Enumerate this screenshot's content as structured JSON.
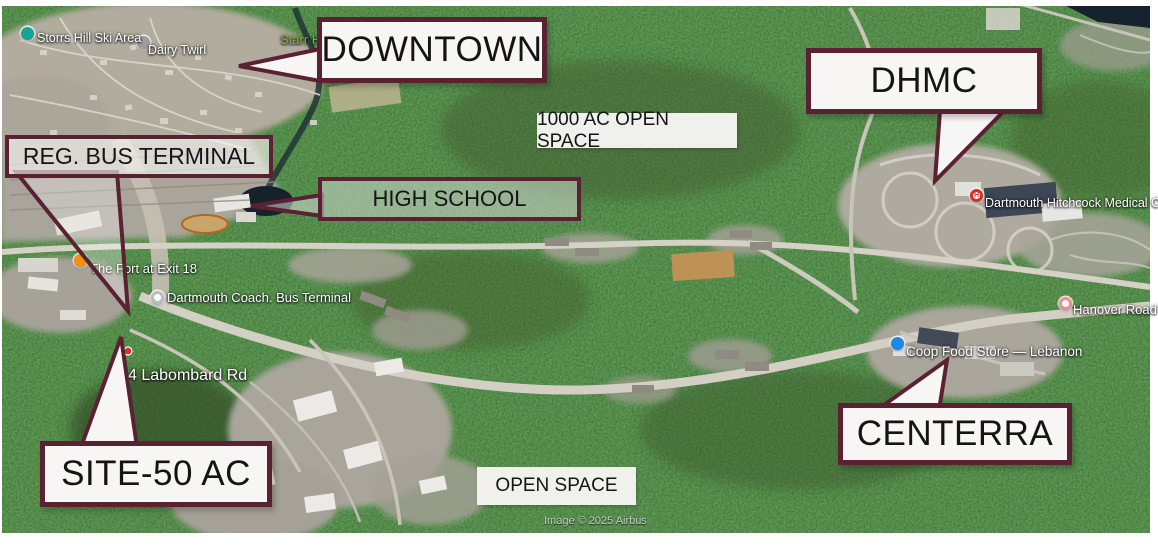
{
  "colors": {
    "callout_border": "#5a2133",
    "callout_fill": "#f8f6f4",
    "forest_base": "#273c1d",
    "park_label_green": "#8aa83e",
    "hospital_pin_red": "#d93025",
    "store_pin_blue": "#1e88e5",
    "restaurant_pin_orange": "#f29111",
    "park_pin_teal": "#18a493"
  },
  "callouts": [
    {
      "name": "downtown",
      "label": "DOWNTOWN"
    },
    {
      "name": "dhmc",
      "label": "DHMC"
    },
    {
      "name": "reg-bus-terminal",
      "label": "REG. BUS TERMINAL"
    },
    {
      "name": "high-school",
      "label": "HIGH SCHOOL"
    },
    {
      "name": "centerra",
      "label": "CENTERRA"
    },
    {
      "name": "site-50-ac",
      "label": "SITE-50 AC"
    }
  ],
  "area_labels": [
    {
      "name": "open-space-1000-ac",
      "label": "1000 AC OPEN SPACE"
    },
    {
      "name": "open-space",
      "label": "OPEN SPACE"
    }
  ],
  "map_pois": [
    {
      "name": "storrs-hill-ski-area",
      "label": "Storrs Hill Ski Area"
    },
    {
      "name": "dairy-twirl",
      "label": "Dairy Twirl"
    },
    {
      "name": "starr-h",
      "label": "Starr H"
    },
    {
      "name": "the-fort-at-exit-18",
      "label": "The Fort at Exit 18"
    },
    {
      "name": "dartmouth-coach-bus-terminal",
      "label": "Dartmouth Coach. Bus Terminal"
    },
    {
      "name": "dartmouth-hitchcock-medical-ctr",
      "label": "Dartmouth Hitchcock Medical Ctr"
    },
    {
      "name": "hanover-road",
      "label": "Hanover Road"
    },
    {
      "name": "coop-food-store",
      "label": "Coop Food Store — Lebanon"
    },
    {
      "name": "labombard-rd",
      "label": "4 Labombard Rd"
    },
    {
      "name": "hospital-pin-letter",
      "label": "H"
    }
  ],
  "attribution": "Image © 2025 Airbus"
}
